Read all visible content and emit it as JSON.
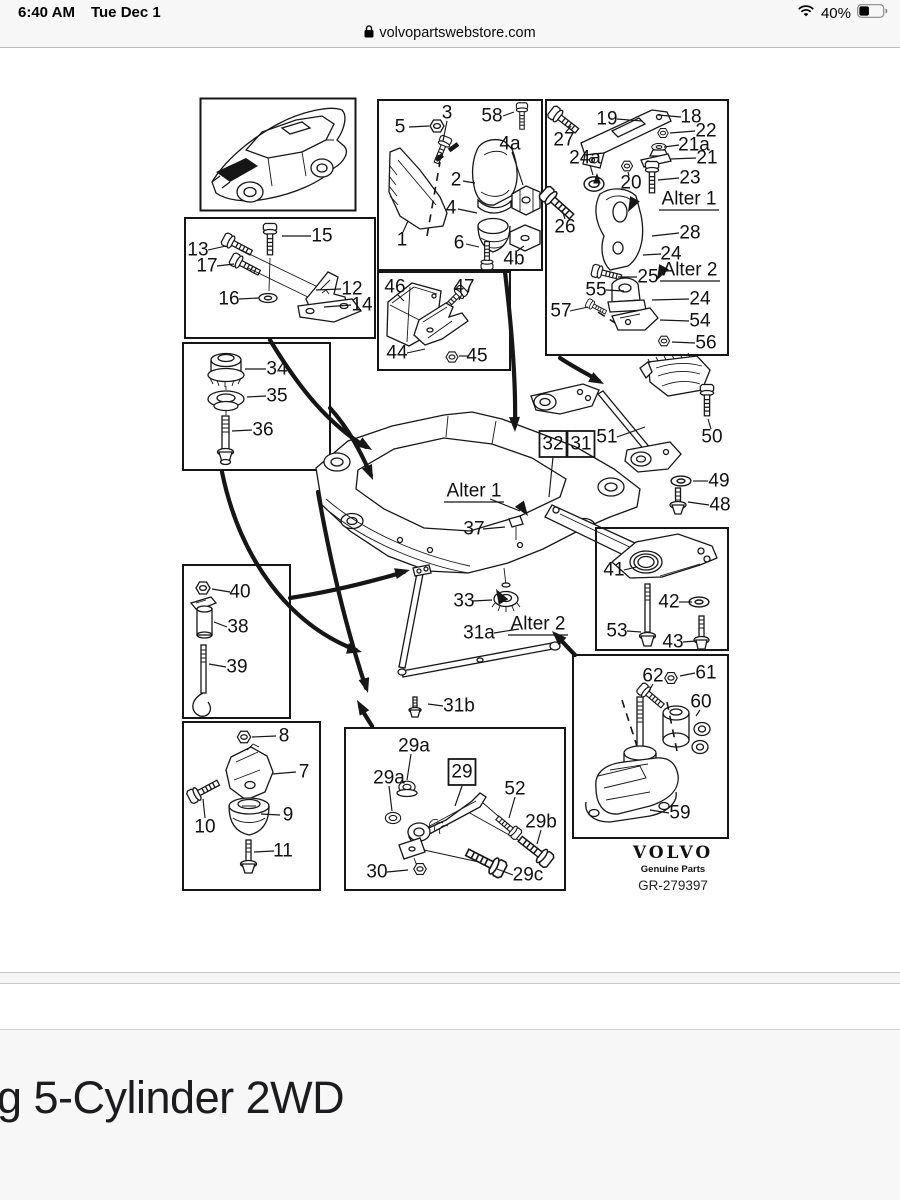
{
  "status_bar": {
    "time": "6:40 AM",
    "date": "Tue Dec 1",
    "battery_percent": "40%"
  },
  "address_bar": {
    "url": "volvopartswebstore.com"
  },
  "footer": {
    "heading": "g 5-Cylinder 2WD"
  },
  "logo": {
    "brand": "VOLVO",
    "tagline": "Genuine Parts",
    "code": "GR-279397"
  },
  "diagram": {
    "labels": [
      {
        "t": "5",
        "x": 400,
        "y": 127,
        "l": [
          409,
          127,
          429,
          126
        ]
      },
      {
        "t": "3",
        "x": 447,
        "y": 113,
        "l": [
          447,
          121,
          443,
          141
        ]
      },
      {
        "t": "58",
        "x": 492,
        "y": 116,
        "l": [
          503,
          116,
          514,
          112
        ]
      },
      {
        "t": "4a",
        "x": 510,
        "y": 144,
        "l": [
          512,
          152,
          523,
          185
        ]
      },
      {
        "t": "2",
        "x": 456,
        "y": 180,
        "l": [
          463,
          181,
          475,
          183
        ]
      },
      {
        "t": "4",
        "x": 451,
        "y": 208,
        "l": [
          458,
          209,
          477,
          213
        ]
      },
      {
        "t": "6",
        "x": 459,
        "y": 243,
        "l": [
          466,
          244,
          479,
          247
        ]
      },
      {
        "t": "1",
        "x": 402,
        "y": 240,
        "l": [
          403,
          232,
          408,
          221
        ]
      },
      {
        "t": "4b",
        "x": 514,
        "y": 259,
        "l": [
          517,
          251,
          524,
          246
        ]
      },
      {
        "t": "19",
        "x": 607,
        "y": 119,
        "l": [
          617,
          119,
          642,
          121
        ]
      },
      {
        "t": "18",
        "x": 691,
        "y": 117,
        "l": [
          681,
          117,
          658,
          115
        ]
      },
      {
        "t": "22",
        "x": 706,
        "y": 131,
        "l": [
          695,
          131,
          670,
          133
        ]
      },
      {
        "t": "21a",
        "x": 694,
        "y": 145,
        "l": [
          679,
          145,
          664,
          147
        ]
      },
      {
        "t": "21",
        "x": 707,
        "y": 158,
        "l": [
          696,
          158,
          670,
          159
        ]
      },
      {
        "t": "27",
        "x": 564,
        "y": 140,
        "l": [
          566,
          132,
          571,
          126
        ]
      },
      {
        "t": "24a",
        "x": 585,
        "y": 158,
        "l": [
          590,
          165,
          593,
          175
        ]
      },
      {
        "t": "20",
        "x": 631,
        "y": 183,
        "l": [
          629,
          176,
          628,
          172
        ]
      },
      {
        "t": "23",
        "x": 690,
        "y": 178,
        "l": [
          679,
          178,
          658,
          180
        ]
      },
      {
        "t": "Alter 1",
        "x": 689,
        "y": 199,
        "ul": true
      },
      {
        "t": "26",
        "x": 565,
        "y": 227,
        "l": [
          565,
          219,
          562,
          210
        ]
      },
      {
        "t": "28",
        "x": 690,
        "y": 233,
        "l": [
          679,
          233,
          652,
          236
        ]
      },
      {
        "t": "24",
        "x": 671,
        "y": 254,
        "l": [
          661,
          254,
          643,
          255
        ]
      },
      {
        "t": "25",
        "x": 648,
        "y": 277,
        "l": [
          637,
          277,
          618,
          277
        ]
      },
      {
        "t": "Alter 2",
        "x": 690,
        "y": 270,
        "ul": true
      },
      {
        "t": "55",
        "x": 596,
        "y": 290,
        "l": [
          606,
          290,
          624,
          291
        ]
      },
      {
        "t": "24",
        "x": 700,
        "y": 299,
        "l": [
          689,
          299,
          652,
          300
        ]
      },
      {
        "t": "57",
        "x": 561,
        "y": 311,
        "l": [
          570,
          311,
          588,
          307
        ]
      },
      {
        "t": "54",
        "x": 700,
        "y": 321,
        "l": [
          689,
          321,
          660,
          320
        ]
      },
      {
        "t": "56",
        "x": 706,
        "y": 343,
        "l": [
          695,
          343,
          672,
          342
        ]
      },
      {
        "t": "15",
        "x": 322,
        "y": 236,
        "l": [
          311,
          236,
          282,
          236
        ]
      },
      {
        "t": "13",
        "x": 198,
        "y": 250,
        "l": [
          208,
          250,
          226,
          246
        ]
      },
      {
        "t": "17",
        "x": 207,
        "y": 266,
        "l": [
          217,
          266,
          234,
          264
        ]
      },
      {
        "t": "16",
        "x": 229,
        "y": 299,
        "l": [
          239,
          299,
          259,
          298
        ]
      },
      {
        "t": "12",
        "x": 352,
        "y": 289,
        "l": [
          341,
          289,
          316,
          290
        ]
      },
      {
        "t": "14",
        "x": 362,
        "y": 305,
        "l": [
          351,
          305,
          324,
          307
        ]
      },
      {
        "t": "46",
        "x": 395,
        "y": 287,
        "l": [
          397,
          294,
          404,
          301
        ]
      },
      {
        "t": "47",
        "x": 464,
        "y": 287,
        "l": [
          462,
          294,
          459,
          300
        ]
      },
      {
        "t": "44",
        "x": 397,
        "y": 353,
        "l": [
          407,
          353,
          425,
          349
        ]
      },
      {
        "t": "45",
        "x": 477,
        "y": 356,
        "l": [
          468,
          356,
          459,
          356
        ]
      },
      {
        "t": "34",
        "x": 277,
        "y": 369,
        "l": [
          266,
          369,
          245,
          369
        ]
      },
      {
        "t": "35",
        "x": 277,
        "y": 396,
        "l": [
          266,
          396,
          247,
          397
        ]
      },
      {
        "t": "36",
        "x": 263,
        "y": 430,
        "l": [
          252,
          430,
          232,
          431
        ]
      },
      {
        "t": "32",
        "x": 553,
        "y": 444,
        "box": true,
        "l": [
          553,
          457,
          549,
          497
        ]
      },
      {
        "t": "31",
        "x": 581,
        "y": 444,
        "box": true
      },
      {
        "t": "51",
        "x": 607,
        "y": 437,
        "l": [
          617,
          437,
          645,
          427
        ]
      },
      {
        "t": "50",
        "x": 712,
        "y": 437,
        "l": [
          711,
          429,
          708,
          419
        ]
      },
      {
        "t": "49",
        "x": 719,
        "y": 481,
        "l": [
          708,
          481,
          693,
          481
        ]
      },
      {
        "t": "48",
        "x": 720,
        "y": 505,
        "l": [
          709,
          505,
          688,
          502
        ]
      },
      {
        "t": "Alter 1",
        "x": 474,
        "y": 491,
        "ul": true,
        "l": [
          490,
          499,
          520,
          511
        ]
      },
      {
        "t": "37",
        "x": 474,
        "y": 529,
        "l": [
          483,
          529,
          505,
          527
        ]
      },
      {
        "t": "33",
        "x": 464,
        "y": 601,
        "l": [
          473,
          601,
          492,
          600
        ]
      },
      {
        "t": "31a",
        "x": 479,
        "y": 633,
        "l": [
          494,
          633,
          519,
          629
        ]
      },
      {
        "t": "Alter 2",
        "x": 538,
        "y": 624,
        "ul": true
      },
      {
        "t": "31b",
        "x": 459,
        "y": 706,
        "l": [
          443,
          706,
          428,
          704
        ]
      },
      {
        "t": "41",
        "x": 614,
        "y": 570,
        "l": [
          624,
          570,
          636,
          567
        ]
      },
      {
        "t": "42",
        "x": 669,
        "y": 602,
        "l": [
          679,
          602,
          692,
          602
        ]
      },
      {
        "t": "53",
        "x": 617,
        "y": 631,
        "l": [
          627,
          631,
          641,
          632
        ]
      },
      {
        "t": "43",
        "x": 673,
        "y": 642,
        "l": [
          683,
          642,
          696,
          641
        ]
      },
      {
        "t": "40",
        "x": 240,
        "y": 592,
        "l": [
          230,
          592,
          212,
          589
        ]
      },
      {
        "t": "38",
        "x": 238,
        "y": 627,
        "l": [
          227,
          627,
          214,
          622
        ]
      },
      {
        "t": "39",
        "x": 237,
        "y": 667,
        "l": [
          226,
          667,
          209,
          664
        ]
      },
      {
        "t": "8",
        "x": 284,
        "y": 736,
        "l": [
          276,
          736,
          252,
          737
        ]
      },
      {
        "t": "7",
        "x": 304,
        "y": 772,
        "l": [
          296,
          772,
          272,
          774
        ]
      },
      {
        "t": "9",
        "x": 288,
        "y": 815,
        "l": [
          280,
          815,
          261,
          814
        ]
      },
      {
        "t": "10",
        "x": 205,
        "y": 827,
        "l": [
          205,
          818,
          203,
          799
        ]
      },
      {
        "t": "11",
        "x": 283,
        "y": 851,
        "l": [
          274,
          851,
          254,
          852
        ]
      },
      {
        "t": "29a",
        "x": 414,
        "y": 746,
        "l": [
          411,
          754,
          407,
          780
        ]
      },
      {
        "t": "29a",
        "x": 389,
        "y": 778,
        "l": [
          389,
          786,
          392,
          811
        ]
      },
      {
        "t": "29",
        "x": 462,
        "y": 772,
        "box": true,
        "l": [
          462,
          786,
          455,
          806
        ]
      },
      {
        "t": "52",
        "x": 515,
        "y": 789,
        "l": [
          515,
          797,
          509,
          818
        ]
      },
      {
        "t": "29b",
        "x": 541,
        "y": 822,
        "l": [
          541,
          830,
          537,
          844
        ]
      },
      {
        "t": "30",
        "x": 377,
        "y": 872,
        "l": [
          387,
          872,
          408,
          870
        ]
      },
      {
        "t": "29c",
        "x": 528,
        "y": 875,
        "l": [
          513,
          875,
          497,
          869
        ]
      },
      {
        "t": "62",
        "x": 653,
        "y": 676,
        "l": [
          653,
          684,
          649,
          691
        ]
      },
      {
        "t": "61",
        "x": 706,
        "y": 673,
        "l": [
          695,
          673,
          680,
          676
        ]
      },
      {
        "t": "60",
        "x": 701,
        "y": 702,
        "l": [
          700,
          710,
          696,
          716
        ]
      },
      {
        "t": "59",
        "x": 680,
        "y": 813,
        "l": [
          669,
          813,
          650,
          810
        ]
      }
    ]
  }
}
